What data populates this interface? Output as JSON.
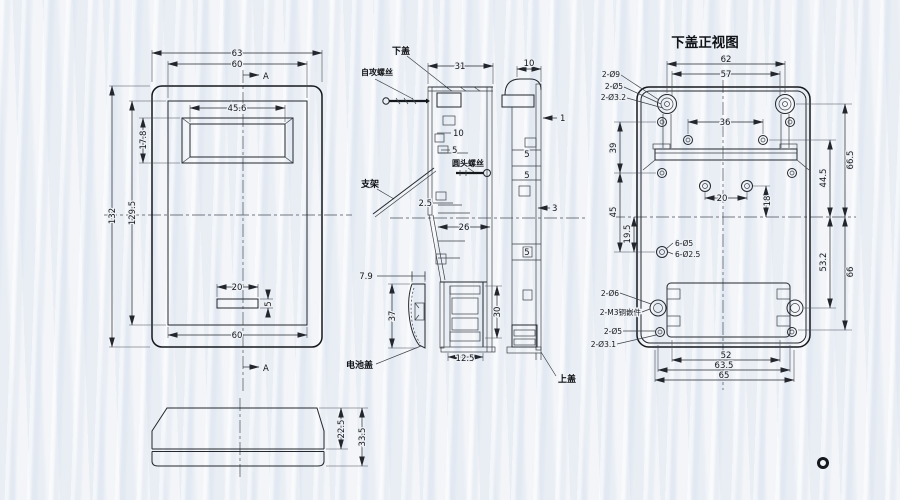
{
  "d": {
    "title": "下盖正视图",
    "lab": {
      "xiagai": "下盖",
      "zigong": "自攻螺丝",
      "yuantou": "圆头螺丝",
      "zhijia": "支架",
      "dianchigai": "电池盖",
      "shanggai": "上盖",
      "a1": "A",
      "a2": "A"
    },
    "fv": {
      "w63": "63",
      "w60": "60",
      "w456": "45.6",
      "h178": "17.8",
      "h132": "132",
      "h1295": "129.5",
      "s20": "20",
      "s5": "5",
      "b60": "60"
    },
    "pv": {
      "v225": "22.5",
      "v335": "33.5"
    },
    "sv": {
      "d31": "31",
      "r10": "10",
      "r5": "5",
      "o25": "2.5",
      "s26": "26",
      "t79": "7.9",
      "h37": "37",
      "w125": "12.5",
      "h30": "30"
    },
    "tc": {
      "d10": "10",
      "w1": "1",
      "p5a": "5",
      "p5b": "5",
      "p3": "3",
      "p5c": "5"
    },
    "bc": {
      "w62": "62",
      "w57": "57",
      "h9": "2-Ø9",
      "h5": "2-Ø5",
      "h32": "2-Ø3.2",
      "p36": "36",
      "p20": "20",
      "p18": "18",
      "l39": "39",
      "l45": "45",
      "l195": "19.5",
      "h65": "6-Ø5",
      "h625": "6-Ø2.5",
      "r665": "66.5",
      "r445": "44.5",
      "r532": "53.2",
      "r66": "66",
      "hb6": "2-Ø6",
      "hbm3": "2-M3铜嵌件",
      "hb5": "2-Ø5",
      "hb31": "2-Ø3.1",
      "b52": "52",
      "b635": "63.5",
      "b65": "65"
    }
  }
}
